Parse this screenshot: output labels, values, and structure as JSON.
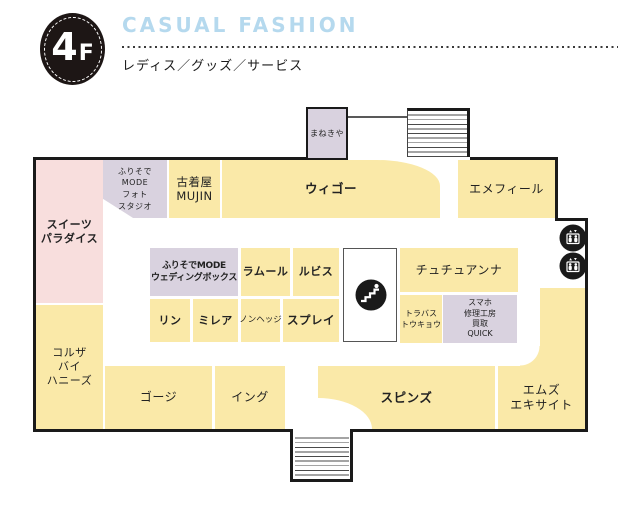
{
  "header": {
    "floor_badge": {
      "number": "4",
      "suffix": "F"
    },
    "title": "CASUAL FASHION",
    "subtitle": "レディス／グッズ／サービス"
  },
  "colors": {
    "block_yellow": "#FAE9A8",
    "block_pink": "#F8DEDD",
    "block_purple": "#D9D2DF",
    "outline_black": "#1A1A1A",
    "title_blue": "#B5D9EE"
  },
  "icons": {
    "elevator_upper": "elevator",
    "elevator_lower": "elevator",
    "escalator_center": "escalator"
  },
  "stores": {
    "sweets_paradise": {
      "line1": "スイーツ",
      "line2": "パラダイス"
    },
    "furisode_mode_photo": {
      "line1": "ふりそで",
      "line2": "MODE",
      "line3": "フォト",
      "line4": "スタジオ"
    },
    "furugiya_mujin": {
      "line1": "古着屋",
      "line2": "MUJIN"
    },
    "wego": {
      "label": "ウィゴー"
    },
    "manekiya": {
      "label": "まねきや"
    },
    "aimerfeel": {
      "label": "エメフィール"
    },
    "furisode_mode_wedding_box": {
      "line1": "ふりそでMODE",
      "line2": "ウェディングボックス"
    },
    "lamour": {
      "label": "ラムール"
    },
    "rubis": {
      "label": "ルビス"
    },
    "rin": {
      "label": "リン"
    },
    "mirea": {
      "label": "ミレア"
    },
    "nonhedge": {
      "label": "ノンヘッジ"
    },
    "spray": {
      "label": "スプレイ"
    },
    "tutuanna": {
      "label": "チュチュアンナ"
    },
    "travas_tokyo": {
      "line1": "トラバス",
      "line2": "トウキョウ"
    },
    "smartphone_quick": {
      "line1": "スマホ",
      "line2": "修理工房",
      "line3": "買取",
      "line4": "QUICK"
    },
    "colza_by_honeys": {
      "line1": "コルザ",
      "line2": "バイ",
      "line3": "ハニーズ"
    },
    "gorge": {
      "label": "ゴージ"
    },
    "ing": {
      "label": "イング"
    },
    "spinns": {
      "label": "スピンズ"
    },
    "ms_excite": {
      "line1": "エムズ",
      "line2": "エキサイト"
    }
  }
}
